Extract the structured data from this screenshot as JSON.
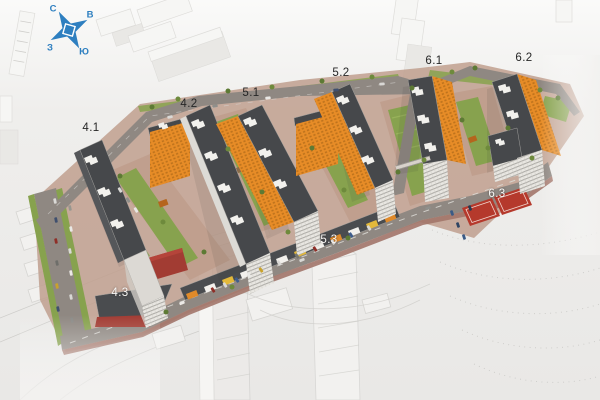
{
  "compass": {
    "north": "С",
    "east": "В",
    "south": "Ю",
    "west": "З"
  },
  "labels": [
    {
      "id": "4.1",
      "x": 91,
      "y": 128,
      "style": "dark"
    },
    {
      "id": "4.2",
      "x": 189,
      "y": 104,
      "style": "dark"
    },
    {
      "id": "5.1",
      "x": 251,
      "y": 93,
      "style": "dark"
    },
    {
      "id": "5.2",
      "x": 341,
      "y": 73,
      "style": "dark"
    },
    {
      "id": "6.1",
      "x": 434,
      "y": 61,
      "style": "dark"
    },
    {
      "id": "6.2",
      "x": 524,
      "y": 58,
      "style": "dark"
    },
    {
      "id": "4.3",
      "x": 120,
      "y": 293,
      "style": "light"
    },
    {
      "id": "5.3",
      "x": 329,
      "y": 240,
      "style": "light"
    },
    {
      "id": "6.3",
      "x": 497,
      "y": 194,
      "style": "light"
    }
  ],
  "colors": {
    "facade_orange": "#e78c27",
    "roof_dark": "#46484b",
    "lawn_green": "#87a24e",
    "road_gray": "#8f8882",
    "paving_pink": "#c09f8e",
    "court_red": "#b5392c",
    "compass_blue": "#2e7fc0",
    "label_dark": "#262626",
    "label_light": "#f7f6f4"
  }
}
